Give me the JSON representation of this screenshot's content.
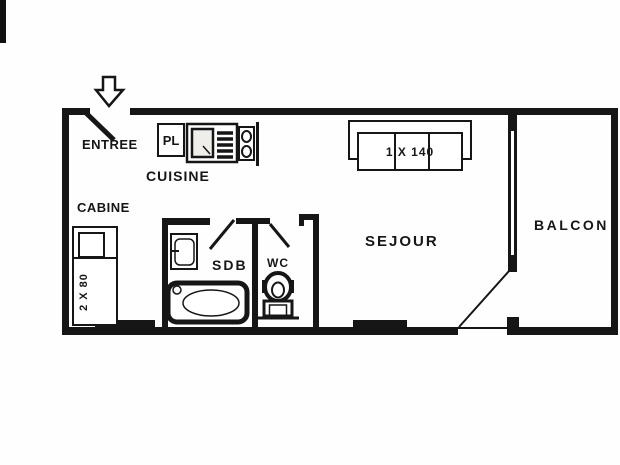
{
  "rooms": {
    "entree": "ENTREE",
    "cuisine": "CUISINE",
    "cabine": "CABINE",
    "sdb": "SDB",
    "wc": "WC",
    "sejour": "SEJOUR",
    "balcon": "BALCON"
  },
  "fixtures": {
    "closet": "PL",
    "sofa_bed": "1 X 140",
    "bunk_bed": "2 X 80"
  },
  "colors": {
    "wall": "#161616",
    "background": "#ffffff"
  }
}
